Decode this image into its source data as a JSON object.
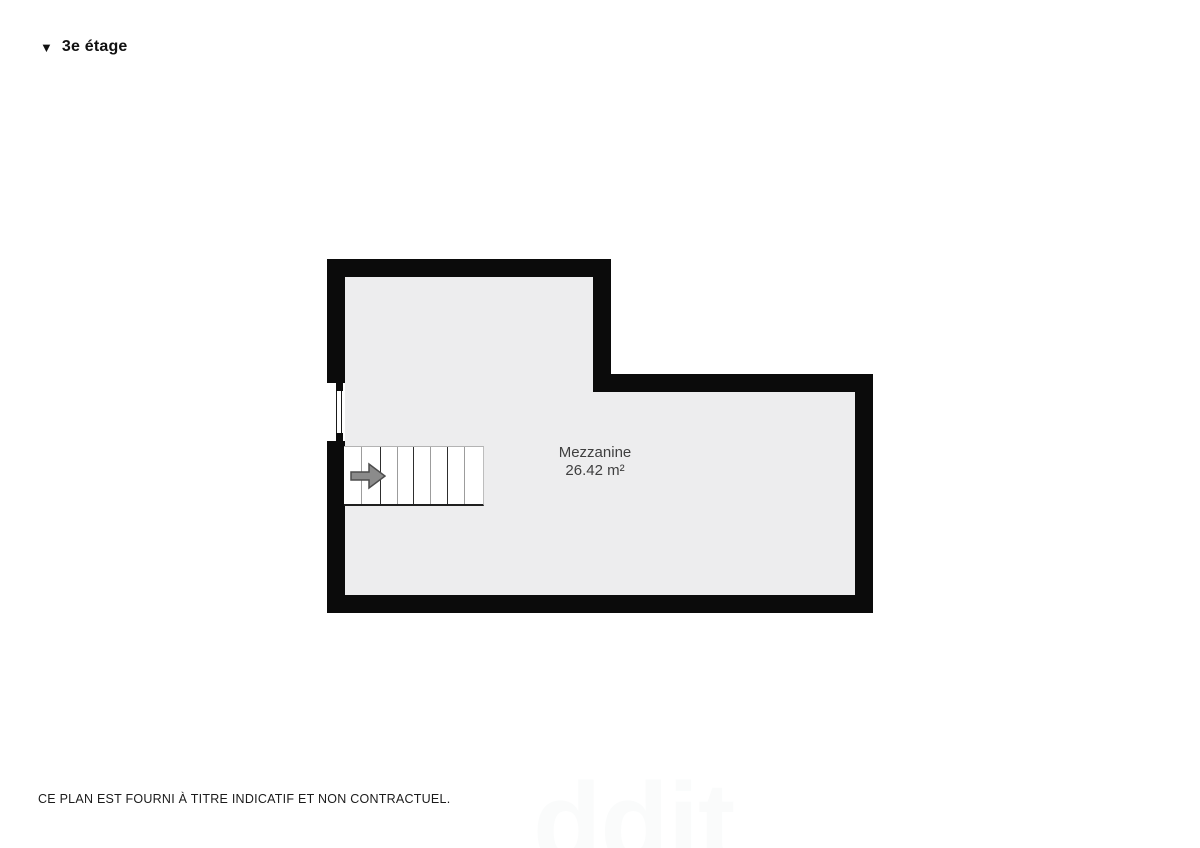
{
  "header": {
    "marker_icon": "▼",
    "floor_label": "3e étage"
  },
  "plan": {
    "room": {
      "name": "Mezzanine",
      "area": "26.42 m²"
    },
    "stairs": {
      "tread_lines": 7,
      "direction": "right"
    },
    "colors": {
      "wall": "#0b0b0b",
      "floor": "#ededee",
      "stair_fill": "#ffffff",
      "tread_dark": "#2e2e2e",
      "tread_light": "#9c9c9c",
      "arrow_fill": "#8b8b8b",
      "arrow_stroke": "#4d4d4d",
      "label_text": "#3f3f3f"
    }
  },
  "footer": {
    "disclaimer": "CE PLAN EST FOURNI À TITRE INDICATIF ET NON CONTRACTUEL."
  },
  "watermark": {
    "text": "ddit"
  }
}
